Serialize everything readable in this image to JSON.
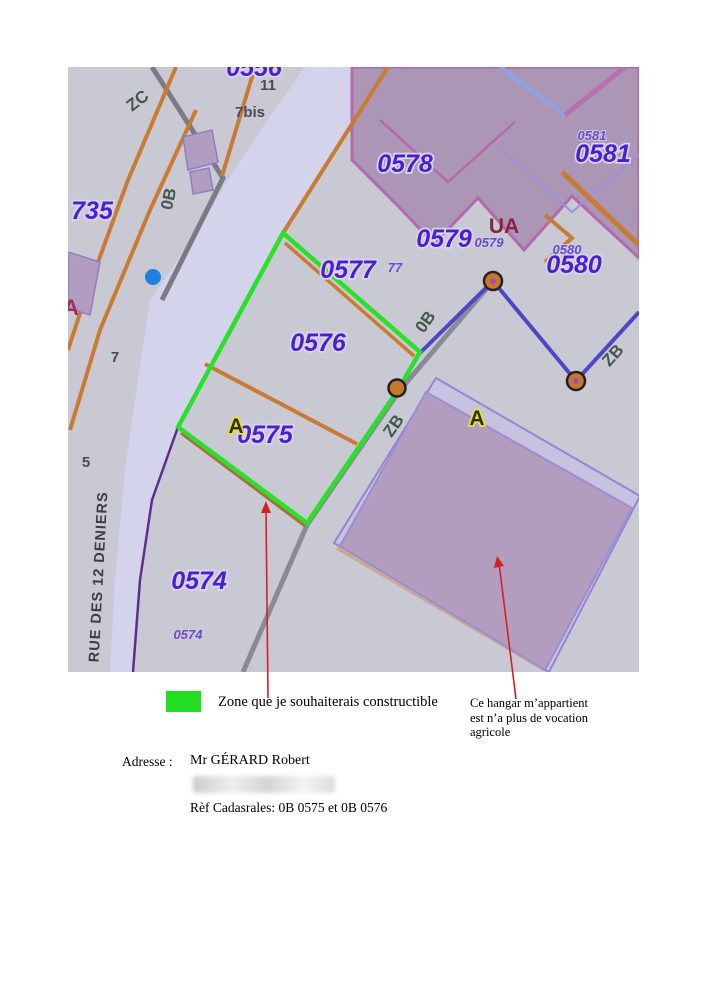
{
  "map": {
    "parcel_labels": [
      "0556",
      "735",
      "0574",
      "0575",
      "0576",
      "0577",
      "0578",
      "0579",
      "0580",
      "0581"
    ],
    "small_labels": [
      "0574",
      "77",
      "0579",
      "0580",
      "0581"
    ],
    "house_numbers": [
      "11",
      "7bis",
      "7",
      "5"
    ],
    "zone_labels": [
      "ZC",
      "0B",
      "0B",
      "ZB",
      "ZB"
    ],
    "street_name": "RUE DES 12 DENIERS",
    "ua_label": "UA",
    "building_markers": [
      "A",
      "A"
    ],
    "red_marker": "A",
    "colors": {
      "highlight_green": "#22dd22",
      "arrow_red": "#d42222",
      "parcel_number_purple": "#4a1ed2",
      "ua_zone_fill": "#ab96b5",
      "street_fill": "#d3d4ec",
      "orange_boundary": "#c97a33"
    }
  },
  "legend": {
    "swatch_color": "#22dd22",
    "zone_label": "Zone que je souhaiterais constructible"
  },
  "annotations": {
    "hangar_note_lines": [
      "Ce hangar m’appartient",
      "est n’a plus de vocation",
      "agricole"
    ]
  },
  "address_block": {
    "label": "Adresse :",
    "name": "Mr GÉRARD Robert",
    "cadastral_ref": "Rèf Cadasrales: 0B 0575 et 0B 0576"
  }
}
